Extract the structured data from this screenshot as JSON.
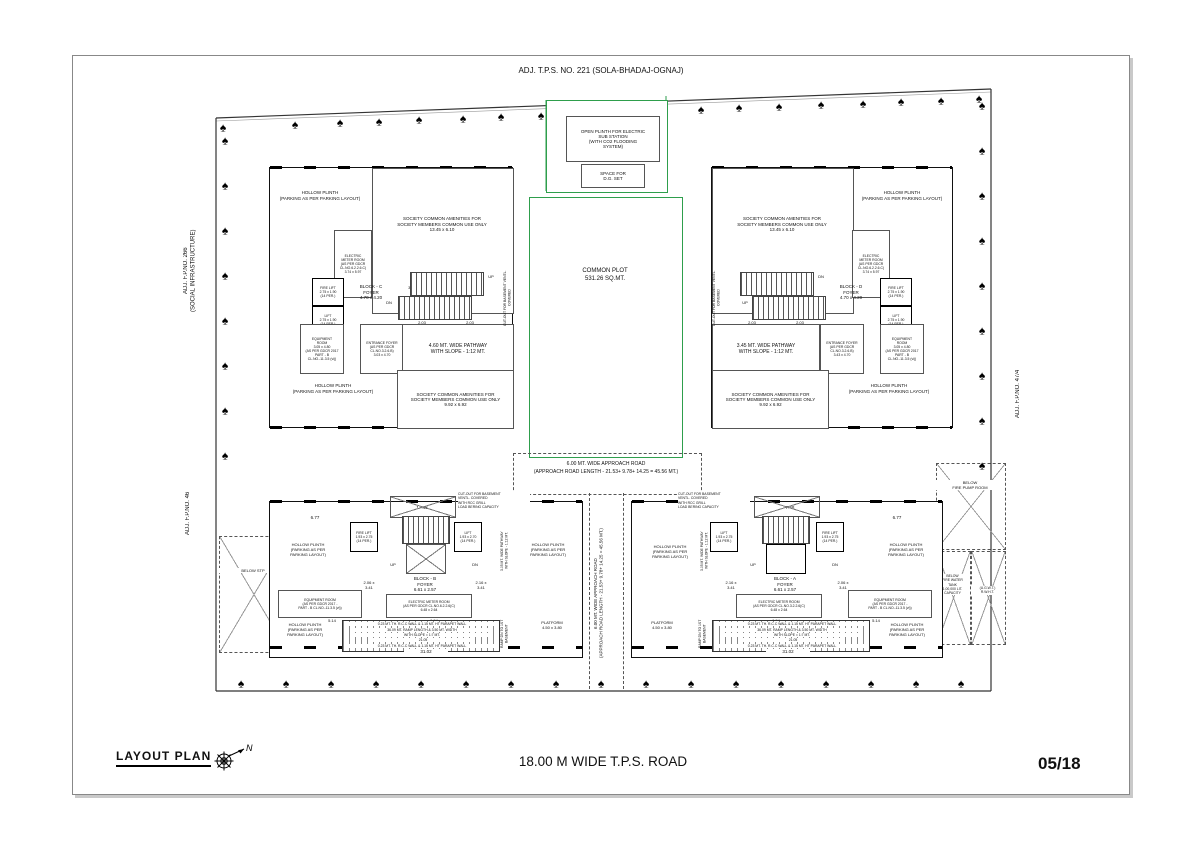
{
  "sheet": {
    "title": "LAYOUT PLAN",
    "number": "05/18",
    "road_label": "18.00 M WIDE T.P.S. ROAD",
    "north_letter": "N"
  },
  "icons": {
    "tree_glyph": "♠"
  },
  "colors": {
    "plot_green": "#2e9e4c",
    "line_black": "#111111"
  },
  "adjacent": {
    "top": "ADJ. T.P.S. NO. 221 (SOLA-BHADAJ-OGNAJ)",
    "left_upper": "ADJ. F.P.NO. 266\n(SOCIAL INFRASTRUCTURE)",
    "left_lower": "ADJ. F.P.NO. 46",
    "right": "ADJ. F.P.NO. 47/4"
  },
  "substation": {
    "plinth": "OPEN PLINTH FOR ELECTRIC\nSUB STATION\n(WITH CO2 FLOODING\nSYSTEM)",
    "dg_set": "SPACE FOR\nD.G. SET"
  },
  "common_plot": {
    "label": "COMMON PLOT\n531.26 SQ.MT."
  },
  "approach_road": {
    "line1": "6.00 MT. WIDE APPROACH ROAD",
    "line2": "(APPROACH ROAD LENGTH - 21.53+ 9.78+ 14.25 =  45.56 MT.)",
    "vertical": "6.00 MT. WIDE APPROACH ROAD\n(APPROACH ROAD LENGTH - 21.53+ 9.78+ 14.25 = 45.56 MT.)"
  },
  "site": {
    "below_stp": "BELOW STP",
    "fire_pump_room": "BELOW\nFIRE PUMP ROOM",
    "fire_water_tank": "BELOW\nFIRE WATER\nTANK\n1,00,000 LIT.\nCAPACITY",
    "rwht": "(U.G.W.T.)\nR.W.H.T."
  },
  "block_c": {
    "title": "BLOCK - C\nFOYER\n4.70 x 4.20",
    "foyer2": "FOYER\n3.83 x 2.18",
    "fire_lift": "FIRE LIFT\n2.75 x 1.90\n(14 PER.)",
    "lift": "LIFT\n2.75 x 1.90\n(14 PER.)",
    "hollow_plinth": "HOLLOW PLINTH\n(PARKING AS PER PARKING LAYOUT)",
    "amenities_top": "SOCIETY COMMON AMENITIES FOR\nSOCIETY MEMBERS COMMON USE ONLY\n13.45 x 6.10",
    "amenities_bottom": "SOCIETY COMMON AMENITIES FOR\nSOCIETY MEMBERS COMMON USE ONLY\n9.92 x 6.92",
    "electric_meter": "ELECTRIC\nMETER ROOM\n(AS PER GDCR\nCL.NO.6.2.2.6.C)\n3.74 x 5.97",
    "equipment": "EQUIPMENT\nROOM\n3.05 x 4.80\n(AS PER GDCR 2017\nPART - B\nCL.NO.-11.3.5 (vi))",
    "entrance_foyer": "ENTRANCE FOYER\n(AS PER GDCR\nCL.NO.3.2.6.B)\n3.03 x 4.70",
    "pathway": "4.60 MT. WIDE PATHWAY\nWITH SLOPE - 1:12 MT.",
    "cutout_side": "CUT-OUT FOR BASEMENT VENTL. COVERED",
    "up": "UP",
    "dn": "DN",
    "dim_stair": "2.03"
  },
  "block_d": {
    "title": "BLOCK - D\nFOYER\n4.70 x 4.20",
    "foyer2": "FOYER\n3.55 x 3.27",
    "fire_lift": "FIRE LIFT\n2.75 x 1.90\n(14 PER.)",
    "lift": "LIFT\n2.75 x 1.90\n(14 PER.)",
    "hollow_plinth": "HOLLOW PLINTH\n(PARKING AS PER PARKING LAYOUT)",
    "amenities_top": "SOCIETY COMMON AMENITIES FOR\nSOCIETY MEMBERS COMMON USE ONLY\n13.45 x 6.10",
    "amenities_bottom": "SOCIETY COMMON AMENITIES FOR\nSOCIETY MEMBERS COMMON USE ONLY\n9.92 x 6.92",
    "electric_meter": "ELECTRIC\nMETER ROOM\n(AS PER GDCR\nCL.NO.6.2.2.6.C)\n3.74 x 5.97",
    "equipment": "EQUIPMENT\nROOM\n3.05 x 4.80\n(AS PER GDCR 2017\nPART - B\nCL.NO.-11.3.5 (vi))",
    "entrance_foyer": "ENTRANCE FOYER\n(AS PER GDCR\nCL.NO.3.2.6.B)\n3.43 x 4.70",
    "pathway": "3.45 MT. WIDE PATHWAY\nWITH SLOPE - 1:12 MT.",
    "cutout_side": "CUT-OUT FOR BASEMENT VENTL. COVERED",
    "up": "UP",
    "dn": "DN",
    "dim_stair": "2.03"
  },
  "block_b": {
    "title": "BLOCK - B\nFOYER\n6.61 x 2.57",
    "fire_lift": "FIRE LIFT\n1.93 x 2.75\n(14 PER.)",
    "lift": "LIFT\n1.93 x 2.70\n(14 PER.)",
    "room_left": "2.06 x\n3.41",
    "room_right": "2.16 x\n3.41",
    "cutout": "CUT-OUT FOR BASEMENT\nVENTL. COVERED\nWITH RCC GRILL\nLOAD BERING CAPACITY",
    "hollow_plinth": "HOLLOW PLINTH\n(PARKING AS PER\nPARKING LAYOUT)",
    "equipment": "EQUIPMENT ROOM\n(AS PER GDCR 2017 -\nPART - B CL.NO.-11.3.5 (vi))",
    "electric_meter": "ELECTRIC METER ROOM\n(AS PER GDCR CL.NO.6.2.2.6(C)\n6.48 x 2.64",
    "ramp_wall": "0.23 MT. TH. R.C.C WALL & 1.15 MT. HT PARAPET WALL",
    "ramp_line1": "36.09 MT. RAMP LENGTH & 3.50 MT. WIDTH",
    "ramp_line2": "WITH SLOPE = 1:7 MT.",
    "ramp_dim": "21.05",
    "platform": "PLATFORM\n4.50 x 3.80",
    "ramp_dn": "RAMP DN TO 1ST\nBASEMENT",
    "pathway_v": "3.05 MT. WIDE PATHWAY\nWITH SLOPE - 1:12 MT.",
    "dim_top": "17.48",
    "dim_corner": "6.77",
    "dim_bottom": "31.02",
    "dim_a": "5.14",
    "dim_b": "6.94",
    "up": "UP",
    "dn": "DN"
  },
  "block_a": {
    "title": "BLOCK - A\nFOYER\n6.61 x 2.57",
    "fire_lift": "FIRE LIFT\n1.93 x 2.75\n(14 PER.)",
    "lift": "LIFT\n1.93 x 2.75\n(14 PER.)",
    "room_left": "2.16 x\n3.41",
    "room_right": "2.06 x\n3.41",
    "cutout": "CUT-OUT FOR BASEMENT\nVENTL. COVERED\nWITH RCC GRILL\nLOAD BERING CAPACITY",
    "hollow_plinth": "HOLLOW PLINTH\n(PARKING AS PER\nPARKING LAYOUT)",
    "equipment": "EQUIPMENT ROOM\n(AS PER GDCR 2017 -\nPART - B CL.NO.-11.3.5 (vi))",
    "electric_meter": "ELECTRIC METER ROOM\n(AS PER GDCR CL.NO.3.2.2.6(C)\n6.48 x 2.64",
    "ramp_wall": "0.23 MT. TH. R.C.C WALL & 1.15 MT. HT PARAPET WALL",
    "ramp_line1": "36.09 MT. RAMP LENGTH & 3.50 MT. WIDTH",
    "ramp_line2": "WITH SLOPE = 1:7 MT.",
    "ramp_dim": "21.05",
    "platform": "PLATFORM\n4.50 x 3.80",
    "ramp_dn": "RAMP DN TO 1ST\nBASEMENT",
    "pathway_v": "3.05 MT. WIDE PATHWAY\nWITH SLOPE - 1:12 MT.",
    "dim_top": "7.48",
    "dim_corner": "6.77",
    "dim_bottom": "31.02",
    "dim_a": "6.94",
    "dim_b": "5.14",
    "up": "UP",
    "dn": "DN"
  }
}
